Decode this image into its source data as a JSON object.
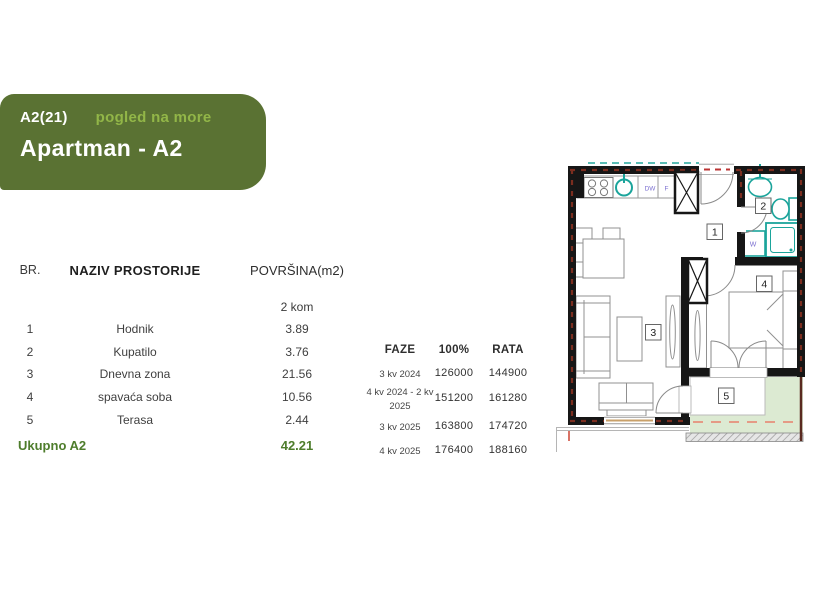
{
  "header": {
    "unit_code": "A2(21)",
    "view_label": "pogled na more",
    "title": "Apartman - A2"
  },
  "rooms_table": {
    "columns": {
      "br": "BR.",
      "name": "NAZIV PROSTORIJE",
      "area": "POVRŠINA(m2)"
    },
    "subheader": "2 kom",
    "rows": [
      {
        "br": "1",
        "name": "Hodnik",
        "area": "3.89"
      },
      {
        "br": "2",
        "name": "Kupatilo",
        "area": "3.76"
      },
      {
        "br": "3",
        "name": "Dnevna zona",
        "area": "21.56"
      },
      {
        "br": "4",
        "name": "spavaća soba",
        "area": "10.56"
      },
      {
        "br": "5",
        "name": "Terasa",
        "area": "2.44"
      }
    ],
    "total_label": "Ukupno A2",
    "total_area": "42.21"
  },
  "phases_table": {
    "columns": {
      "faze": "FAZE",
      "full": "100%",
      "rata": "RATA"
    },
    "rows": [
      {
        "faze": "3 kv 2024",
        "full": "126000",
        "rata": "144900"
      },
      {
        "faze": "4 kv 2024 - 2 kv 2025",
        "full": "151200",
        "rata": "161280"
      },
      {
        "faze": "3 kv 2025",
        "full": "163800",
        "rata": "174720"
      },
      {
        "faze": "4 kv 2025",
        "full": "176400",
        "rata": "188160"
      }
    ]
  },
  "plan": {
    "room_labels": {
      "hall": "1",
      "bath": "2",
      "living": "3",
      "bedroom": "4",
      "terrace": "5"
    },
    "fixture_labels": {
      "dishwasher": "DW",
      "fridge": "F",
      "washer": "W"
    }
  },
  "colors": {
    "header_bg": "#5a7233",
    "view_text": "#92b648",
    "total_text": "#4e7d2c",
    "wall_black": "#161616",
    "wall_hatch_red": "#7b2d1f",
    "fixture_teal": "#1ba49b",
    "fixture_label_blue": "#7b6fd0",
    "terrace_green": "#dcead2",
    "terrace_dash": "#e59a85"
  }
}
